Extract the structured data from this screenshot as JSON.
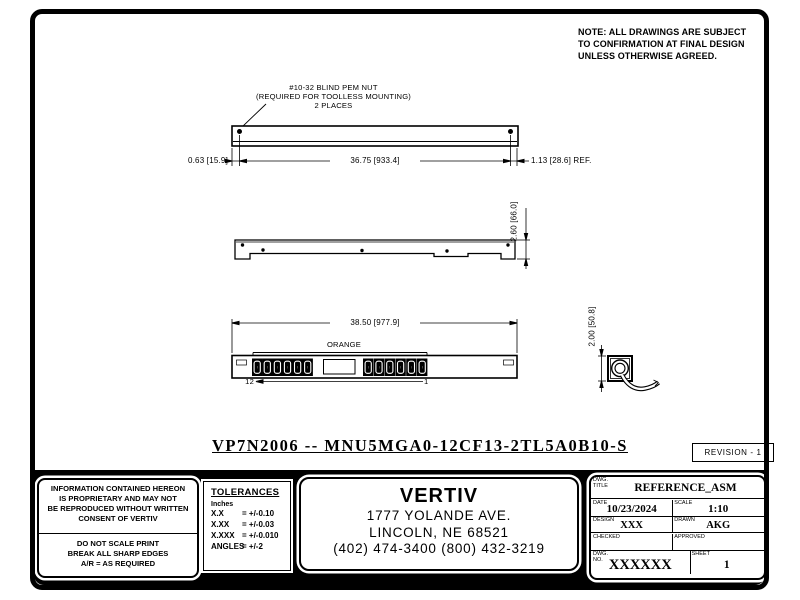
{
  "note": {
    "line1": "NOTE: ALL DRAWINGS ARE SUBJECT",
    "line2": "TO CONFIRMATION AT FINAL DESIGN",
    "line3": "UNLESS OTHERWISE AGREED."
  },
  "top_view": {
    "callout_line1": "#10-32 BLIND PEM NUT",
    "callout_line2": "(REQUIRED FOR TOOLLESS MOUNTING)",
    "callout_line3": "2 PLACES",
    "dim_left": "0.63 [15.9]",
    "dim_span": "36.75 [933.4]",
    "dim_right": "1.13 [28.6] REF."
  },
  "side_view": {
    "dim_height": "2.60 [66.0]"
  },
  "front_view": {
    "dim_width": "38.50 [977.9]",
    "outlet_group_label": "ORANGE",
    "outlet_number_last": "12",
    "outlet_number_first": "1"
  },
  "end_view": {
    "dim_height": "2.00 [50.8]"
  },
  "part_number": "VP7N2006 -- MNU5MGA0-12CF13-2TL5A0B10-S",
  "revision": "REVISION - 1",
  "proprietary": {
    "line1": "INFORMATION CONTAINED HEREON",
    "line2": "IS PROPRIETARY AND MAY NOT",
    "line3": "BE REPRODUCED WITHOUT WRITTEN",
    "line4": "CONSENT OF VERTIV",
    "note1": "DO NOT SCALE PRINT",
    "note2": "BREAK ALL SHARP EDGES",
    "note3": "A/R = AS REQUIRED"
  },
  "tolerances": {
    "title": "TOLERANCES",
    "units": "Inches",
    "rows": [
      {
        "name": "X.X",
        "value": "= +/-0.10"
      },
      {
        "name": "X.XX",
        "value": "= +/-0.03"
      },
      {
        "name": "X.XXX",
        "value": "= +/-0.010"
      },
      {
        "name": "ANGLES",
        "value": "= +/-2"
      }
    ]
  },
  "company": {
    "name": "VERTIV",
    "address": "1777 YOLANDE AVE.",
    "city": "LINCOLN, NE 68521",
    "phone": "(402) 474-3400 (800) 432-3219"
  },
  "title_block": {
    "title_label": "DWG.\nTITLE",
    "title": "REFERENCE_ASM",
    "date_label": "DATE",
    "date": "10/23/2024",
    "scale_label": "SCALE",
    "scale": "1:10",
    "design_label": "DESIGN",
    "design": "XXX",
    "drawn_label": "DRAWN",
    "drawn": "AKG",
    "checked_label": "CHECKED",
    "approved_label": "APPROVED",
    "dwg_no_label": "DWG.\nNO.",
    "dwg_no": "XXXXXX",
    "sheet_label": "SHEET",
    "sheet": "1"
  }
}
